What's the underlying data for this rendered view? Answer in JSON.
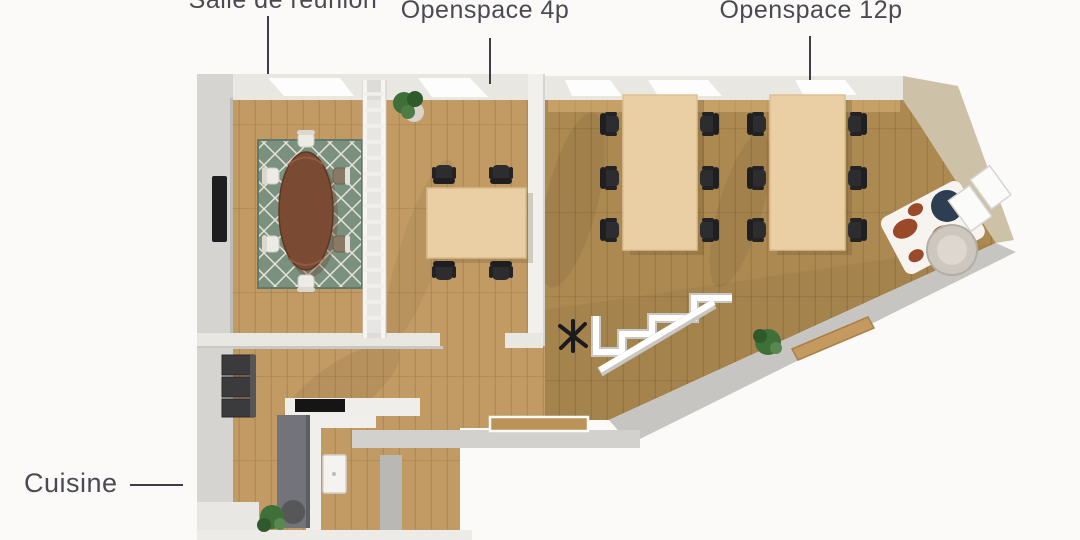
{
  "labels": {
    "meeting_room": "Salle de réunion",
    "openspace_4p": "Openspace 4p",
    "openspace_12p": "Openspace 12p",
    "kitchen": "Cuisine"
  },
  "rooms": [
    {
      "label": "Salle de réunion",
      "items": [
        "oval-meeting-table",
        "meeting-chairs",
        "diamond-area-rug",
        "wall-tv",
        "glass-partition-ladder"
      ]
    },
    {
      "label": "Openspace 4p",
      "items": [
        "desk-4p",
        "office-chairs-x4",
        "potted-plant"
      ]
    },
    {
      "label": "Openspace 12p",
      "items": [
        "desk-6p-x2",
        "office-chairs-x12",
        "cow-print-rug",
        "navy-pouf",
        "lounge-armchair",
        "white-shelves"
      ]
    },
    {
      "label": "Cuisine",
      "items": [
        "tall-dark-cabinets",
        "kitchen-island",
        "cooktop",
        "wall-sink",
        "potted-plant"
      ]
    },
    {
      "label": "",
      "items": [
        "staircase-railing",
        "coat-stand",
        "potted-plant",
        "wood-bench"
      ]
    }
  ],
  "colors": {
    "background": "#fbfaf8",
    "label_text": "#4a4a52",
    "leader_line": "#3e3e46",
    "floor_wood": "#c29a63",
    "floor_wood_dark": "#ad8952",
    "wall_light": "#e9e7e2",
    "wall_gray": "#d5d4d0",
    "wall_beige": "#cdc2a8",
    "rug_green": "#7a9180",
    "table_dark_wood": "#7b4a33",
    "table_light_wood": "#e9cfa3",
    "chair_black": "#2d2d2f",
    "chair_white": "#edebe6",
    "chair_taupe": "#8a7a63",
    "pouf_navy": "#2d3e53",
    "cow_rug_brown": "#9a4a28",
    "plant_green": "#3f7039",
    "island_gray": "#73737a",
    "cabinet_dark": "#3b3b3e",
    "bench_wood": "#c49a60"
  }
}
